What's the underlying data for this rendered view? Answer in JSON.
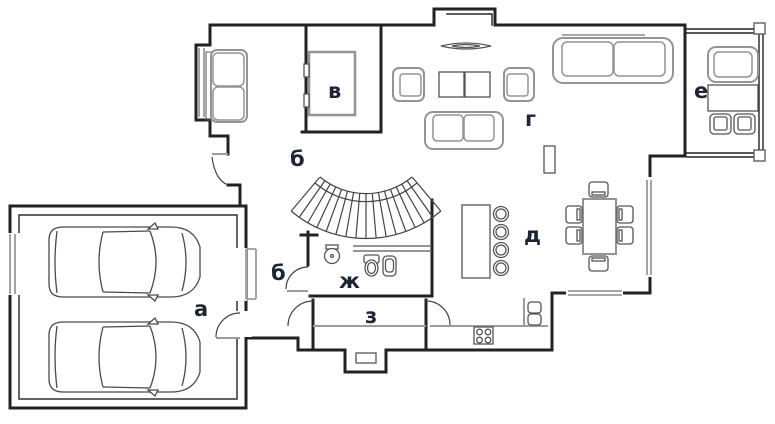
{
  "plan": {
    "type": "floor-plan",
    "colors": {
      "wall": "#222222",
      "furniture": "#949494",
      "window": "#9b9b9b",
      "label": "#1c2532",
      "detail": "#555555",
      "background": "#ffffff"
    },
    "rooms": [
      {
        "id": "garage",
        "label": "а"
      },
      {
        "id": "hall-upper",
        "label": "б"
      },
      {
        "id": "hall-lower",
        "label": "б"
      },
      {
        "id": "closet",
        "label": "в"
      },
      {
        "id": "living-room",
        "label": "г"
      },
      {
        "id": "dining-area",
        "label": "д"
      },
      {
        "id": "terrace",
        "label": "е"
      },
      {
        "id": "bathroom",
        "label": "ж"
      },
      {
        "id": "vestibule",
        "label": "з"
      }
    ]
  }
}
